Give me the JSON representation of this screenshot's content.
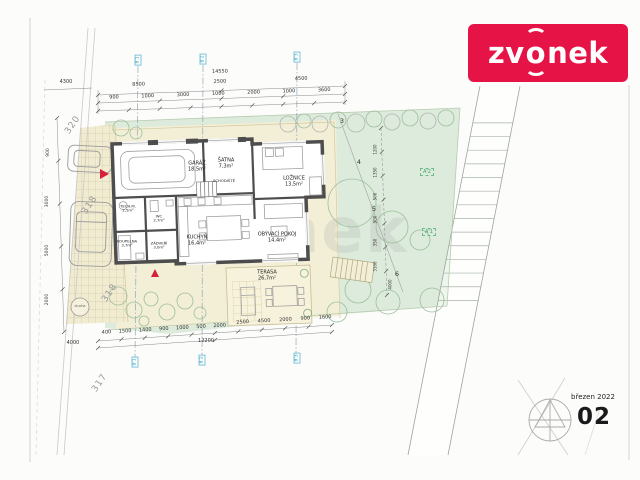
{
  "logo": {
    "text": "zvonek",
    "part1": "zv",
    "part2": "o",
    "part3": "nek",
    "bg_color": "#e61446",
    "text_color": "#ffffff"
  },
  "title_block": {
    "date": "březen 2022",
    "sheet_number": "02"
  },
  "watermark_text": "zvonek",
  "site_plan": {
    "parcel_labels": [
      "320",
      "318",
      "318",
      "317"
    ],
    "boundary_point_labels": [
      "3",
      "4",
      "5",
      "6"
    ],
    "survey_markers": [
      "A'2",
      "A'1"
    ],
    "axis_markers_top": [
      "B'1",
      "B'2",
      "B'3"
    ],
    "axis_markers_bottom": [
      "B'1",
      "B'2",
      "B'3"
    ],
    "well_label": "studna",
    "rooms": [
      {
        "name": "GARÁŽ",
        "area": "18,5m²"
      },
      {
        "name": "ŠATNA",
        "area": "7,3m²"
      },
      {
        "name": "SCHODIŠTĚ",
        "area": ""
      },
      {
        "name": "LOŽNICE",
        "area": "13,5m²"
      },
      {
        "name": "TECH.M.",
        "area": "2,5m²"
      },
      {
        "name": "WC",
        "area": "2,7m²"
      },
      {
        "name": "KOUPELNA",
        "area": "3,7m²"
      },
      {
        "name": "ZÁDVEŘÍ",
        "area": "3,0m²"
      },
      {
        "name": "KUCHYŇ",
        "area": "16,4m²"
      },
      {
        "name": "OBÝVACÍ POKOJ",
        "area": "14,4m²"
      },
      {
        "name": "TERASA",
        "area": "26,7m²"
      }
    ],
    "dimensions": {
      "top_overall": [
        "14550"
      ],
      "top_main": [
        "8500",
        "2500",
        "4500"
      ],
      "top_detail": [
        "900",
        "1000",
        "3000",
        "1000",
        "2000",
        "1000",
        "3600"
      ],
      "top_left": [
        "4300"
      ],
      "bottom_detail": [
        "400",
        "1500",
        "1400",
        "900",
        "1000",
        "500",
        "2000"
      ],
      "bottom_main": [
        "2500",
        "4500",
        "2000",
        "900",
        "1600"
      ],
      "bottom_overall": [
        "12200"
      ],
      "bottom_left": [
        "4000"
      ],
      "left_chain": [
        "900",
        "3000",
        "5000",
        "2000"
      ],
      "garden_chain": [
        "1200",
        "1350",
        "500",
        "900",
        "350",
        "3100"
      ],
      "garden_bottom": [
        "4000"
      ]
    },
    "colors": {
      "lawn": "#dcebdb",
      "paving": "#f3eed6",
      "wall": "#4d4d4d",
      "axis_blue": "#2f9fc4",
      "marker_green": "#3f9e63",
      "accent_red": "#e61446"
    }
  }
}
